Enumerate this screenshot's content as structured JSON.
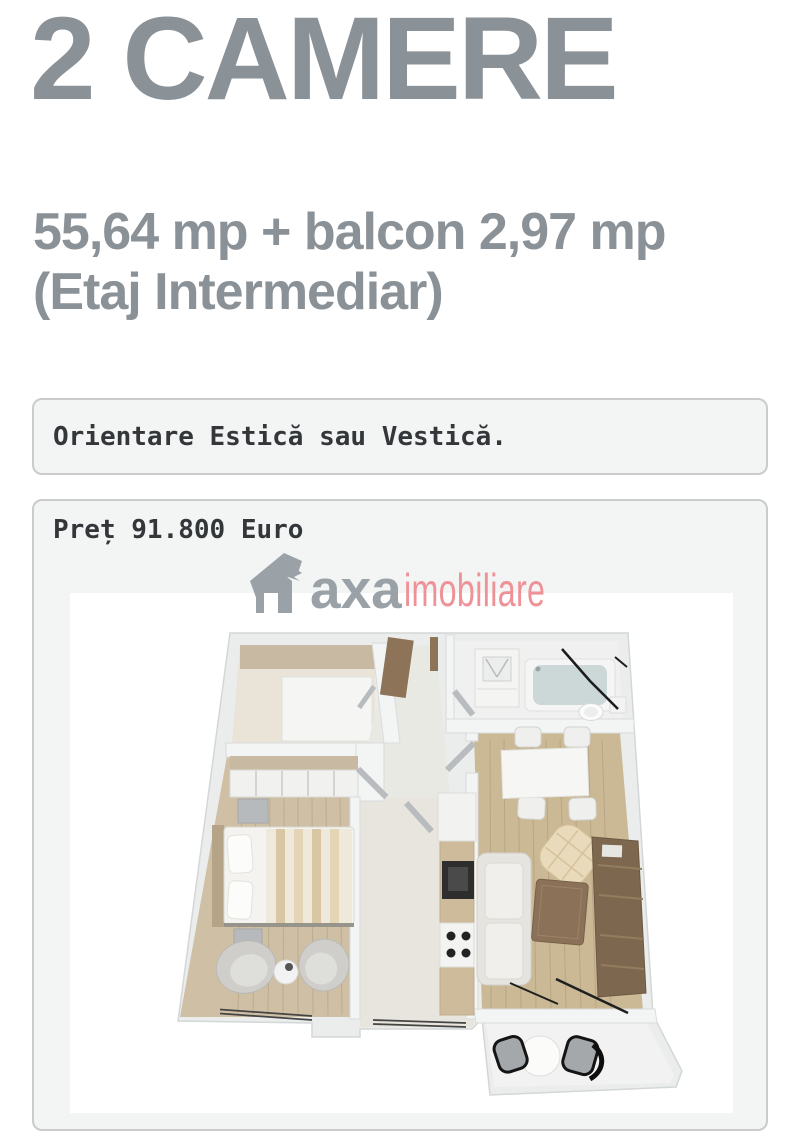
{
  "listing": {
    "title": "2 CAMERE",
    "area_line": "55,64 mp + balcon 2,97 mp",
    "floor_line": "(Etaj Intermediar)",
    "orientation_note": "Orientare Estică sau Vestică.",
    "price_text": "Preț 91.800 Euro"
  },
  "watermark": {
    "brand": "axa",
    "brand_suffix": "imobiliare",
    "icon": "house-arrow-logo-icon",
    "brand_color": "#9aa1a7",
    "suffix_color": "#ee9298"
  },
  "floor_plan": {
    "image_kind": "3d-floor-plan-render"
  },
  "colors": {
    "heading": "#8a9197",
    "box_background": "#f3f4f4",
    "box_border": "#c9cbcd",
    "body_text": "#33373a",
    "page_background": "#ffffff"
  }
}
